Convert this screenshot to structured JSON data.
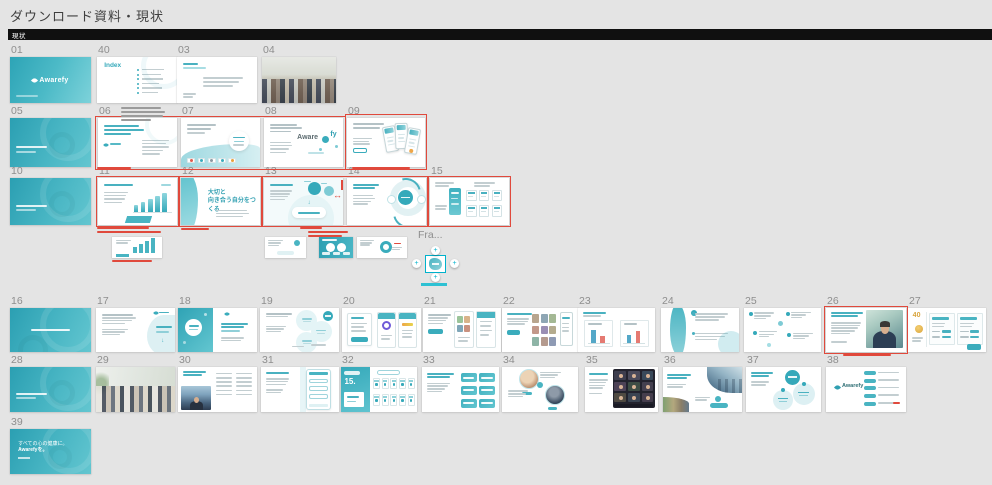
{
  "app": {
    "canvas_title": "ダウンロード資料・現状",
    "section_label": "現状"
  },
  "colors": {
    "canvas_bg": "#e4e4e4",
    "section_bar": "#101010",
    "frame_label": "#8e8e8e",
    "teal": "#35a9ba",
    "teal_light": "#8fd2da",
    "annotation_red": "#e0493c",
    "annotation_gray": "#9b9b9b",
    "selection": "#00b2cc",
    "gold": "#d9a43c"
  },
  "icons": {
    "add_handle": "+",
    "swap_arrow": "↔",
    "arrow_down": "↓"
  },
  "frames": [
    {
      "label": "01",
      "x": 10,
      "y": 57,
      "w": 81,
      "h": 46,
      "v": "teal-cover",
      "texts": {
        "logo": "Awarefy"
      }
    },
    {
      "label": "40",
      "x": 97,
      "y": 57,
      "w": 80,
      "h": 46,
      "v": "index",
      "texts": {
        "title": "Index"
      }
    },
    {
      "label": "03",
      "x": 177,
      "y": 57,
      "w": 80,
      "h": 46,
      "v": "text-simple",
      "texts": {}
    },
    {
      "label": "04",
      "x": 262,
      "y": 57,
      "w": 74,
      "h": 46,
      "v": "photo-a",
      "texts": {}
    },
    {
      "label": "05",
      "x": 10,
      "y": 118,
      "w": 81,
      "h": 49,
      "v": "teal-leaf",
      "texts": {}
    },
    {
      "label": "06",
      "x": 98,
      "y": 118,
      "w": 79,
      "h": 49,
      "v": "text-logo",
      "texts": {}
    },
    {
      "label": "07",
      "x": 181,
      "y": 118,
      "w": 79,
      "h": 49,
      "v": "wave",
      "texts": {}
    },
    {
      "label": "08",
      "x": 264,
      "y": 118,
      "w": 79,
      "h": 49,
      "v": "brand",
      "texts": {
        "t1": "Aware",
        "t2": "fy"
      }
    },
    {
      "label": "09",
      "x": 347,
      "y": 118,
      "w": 78,
      "h": 49,
      "v": "phones",
      "texts": {}
    },
    {
      "label": "10",
      "x": 10,
      "y": 178,
      "w": 81,
      "h": 47,
      "v": "teal-leaf",
      "texts": {}
    },
    {
      "label": "11",
      "x": 98,
      "y": 178,
      "w": 79,
      "h": 47,
      "v": "chart",
      "texts": {}
    },
    {
      "label": "12",
      "x": 181,
      "y": 178,
      "w": 79,
      "h": 47,
      "v": "message",
      "texts": {
        "line1": "大切と",
        "line2": "向き合う自分をつくる"
      }
    },
    {
      "label": "13",
      "x": 264,
      "y": 178,
      "w": 79,
      "h": 47,
      "v": "diagram",
      "texts": {}
    },
    {
      "label": "14",
      "x": 347,
      "y": 178,
      "w": 79,
      "h": 47,
      "v": "cycle",
      "texts": {}
    },
    {
      "label": "15",
      "x": 430,
      "y": 178,
      "w": 79,
      "h": 47,
      "v": "ui-grid",
      "texts": {}
    },
    {
      "label": "16",
      "x": 10,
      "y": 308,
      "w": 81,
      "h": 44,
      "v": "teal-leaf-c",
      "texts": {}
    },
    {
      "label": "17",
      "x": 96,
      "y": 308,
      "w": 79,
      "h": 44,
      "v": "blob-right",
      "texts": {}
    },
    {
      "label": "18",
      "x": 178,
      "y": 308,
      "w": 79,
      "h": 44,
      "v": "split-teal",
      "texts": {}
    },
    {
      "label": "19",
      "x": 260,
      "y": 308,
      "w": 79,
      "h": 44,
      "v": "circles3",
      "texts": {}
    },
    {
      "label": "20",
      "x": 342,
      "y": 308,
      "w": 79,
      "h": 44,
      "v": "form-apps",
      "texts": {}
    },
    {
      "label": "21",
      "x": 423,
      "y": 308,
      "w": 78,
      "h": 44,
      "v": "apps2",
      "texts": {}
    },
    {
      "label": "22",
      "x": 502,
      "y": 308,
      "w": 76,
      "h": 44,
      "v": "media",
      "texts": {}
    },
    {
      "label": "23",
      "x": 578,
      "y": 308,
      "w": 77,
      "h": 44,
      "v": "charts2",
      "texts": {}
    },
    {
      "label": "24",
      "x": 661,
      "y": 308,
      "w": 78,
      "h": 44,
      "v": "teal-shapes",
      "texts": {}
    },
    {
      "label": "25",
      "x": 744,
      "y": 308,
      "w": 77,
      "h": 44,
      "v": "notes",
      "texts": {}
    },
    {
      "label": "26",
      "x": 826,
      "y": 308,
      "w": 80,
      "h": 44,
      "v": "ceo",
      "texts": {}
    },
    {
      "label": "27",
      "x": 908,
      "y": 308,
      "w": 78,
      "h": 44,
      "v": "pricing",
      "texts": {
        "num": "40"
      }
    },
    {
      "label": "28",
      "x": 10,
      "y": 367,
      "w": 81,
      "h": 45,
      "v": "teal-leaf",
      "texts": {}
    },
    {
      "label": "29",
      "x": 96,
      "y": 367,
      "w": 79,
      "h": 45,
      "v": "photo-b",
      "texts": {}
    },
    {
      "label": "30",
      "x": 178,
      "y": 367,
      "w": 79,
      "h": 45,
      "v": "photo-text",
      "texts": {}
    },
    {
      "label": "31",
      "x": 261,
      "y": 367,
      "w": 78,
      "h": 45,
      "v": "phone-big",
      "texts": {}
    },
    {
      "label": "32",
      "x": 341,
      "y": 367,
      "w": 76,
      "h": 45,
      "v": "stats",
      "texts": {
        "num": "15."
      }
    },
    {
      "label": "33",
      "x": 422,
      "y": 367,
      "w": 77,
      "h": 45,
      "v": "cta",
      "texts": {}
    },
    {
      "label": "34",
      "x": 502,
      "y": 367,
      "w": 76,
      "h": 45,
      "v": "people2",
      "texts": {}
    },
    {
      "label": "35",
      "x": 585,
      "y": 367,
      "w": 73,
      "h": 45,
      "v": "video",
      "texts": {}
    },
    {
      "label": "36",
      "x": 663,
      "y": 367,
      "w": 79,
      "h": 45,
      "v": "city",
      "texts": {}
    },
    {
      "label": "37",
      "x": 746,
      "y": 367,
      "w": 75,
      "h": 45,
      "v": "circles-teal",
      "texts": {}
    },
    {
      "label": "38",
      "x": 826,
      "y": 367,
      "w": 80,
      "h": 45,
      "v": "list",
      "texts": {
        "logo": "Awarefy"
      }
    },
    {
      "label": "39",
      "x": 10,
      "y": 429,
      "w": 81,
      "h": 45,
      "v": "closing",
      "texts": {
        "line1": "すべての心の健康に。",
        "line2": "Awarefyを。"
      }
    }
  ],
  "minis": [
    {
      "x": 112,
      "y": 237,
      "w": 50,
      "h": 21,
      "v": "m-chart"
    },
    {
      "x": 265,
      "y": 237,
      "w": 41,
      "h": 21,
      "v": "m-light"
    },
    {
      "x": 319,
      "y": 237,
      "w": 34,
      "h": 21,
      "v": "m-dark"
    },
    {
      "x": 357,
      "y": 237,
      "w": 50,
      "h": 21,
      "v": "m-cycle"
    }
  ],
  "selected": {
    "label": "Fra...",
    "x": 426,
    "y": 256,
    "w": 19,
    "h": 16
  },
  "red_boxes": [
    {
      "x": 95,
      "y": 116,
      "w": 251,
      "h": 54
    },
    {
      "x": 345,
      "y": 114,
      "w": 82,
      "h": 56
    },
    {
      "x": 96,
      "y": 176,
      "w": 83,
      "h": 51
    },
    {
      "x": 179,
      "y": 176,
      "w": 83,
      "h": 51
    },
    {
      "x": 262,
      "y": 176,
      "w": 166,
      "h": 51
    },
    {
      "x": 428,
      "y": 176,
      "w": 83,
      "h": 51
    },
    {
      "x": 824,
      "y": 306,
      "w": 84,
      "h": 48
    }
  ],
  "annotations": [
    {
      "x": 121,
      "y": 107,
      "color": "gray",
      "lines": [
        [
          0,
          0,
          40
        ],
        [
          0,
          4,
          44
        ],
        [
          0,
          8,
          42
        ],
        [
          0,
          12,
          30
        ]
      ]
    },
    {
      "x": 97,
      "y": 167,
      "color": "red",
      "lines": [
        [
          0,
          0,
          34
        ]
      ]
    },
    {
      "x": 352,
      "y": 167,
      "color": "red",
      "lines": [
        [
          0,
          0,
          58
        ]
      ]
    },
    {
      "x": 97,
      "y": 227,
      "color": "red",
      "lines": [
        [
          0,
          0,
          52
        ],
        [
          0,
          4,
          64
        ]
      ]
    },
    {
      "x": 181,
      "y": 228,
      "color": "red",
      "lines": [
        [
          0,
          0,
          28
        ]
      ]
    },
    {
      "x": 300,
      "y": 227,
      "color": "red",
      "lines": [
        [
          0,
          0,
          22
        ],
        [
          8,
          4,
          40
        ],
        [
          8,
          8,
          34
        ]
      ]
    },
    {
      "x": 112,
      "y": 260,
      "color": "red",
      "lines": [
        [
          0,
          0,
          40
        ]
      ]
    },
    {
      "x": 843,
      "y": 354,
      "color": "red",
      "lines": [
        [
          0,
          0,
          48
        ]
      ]
    }
  ]
}
